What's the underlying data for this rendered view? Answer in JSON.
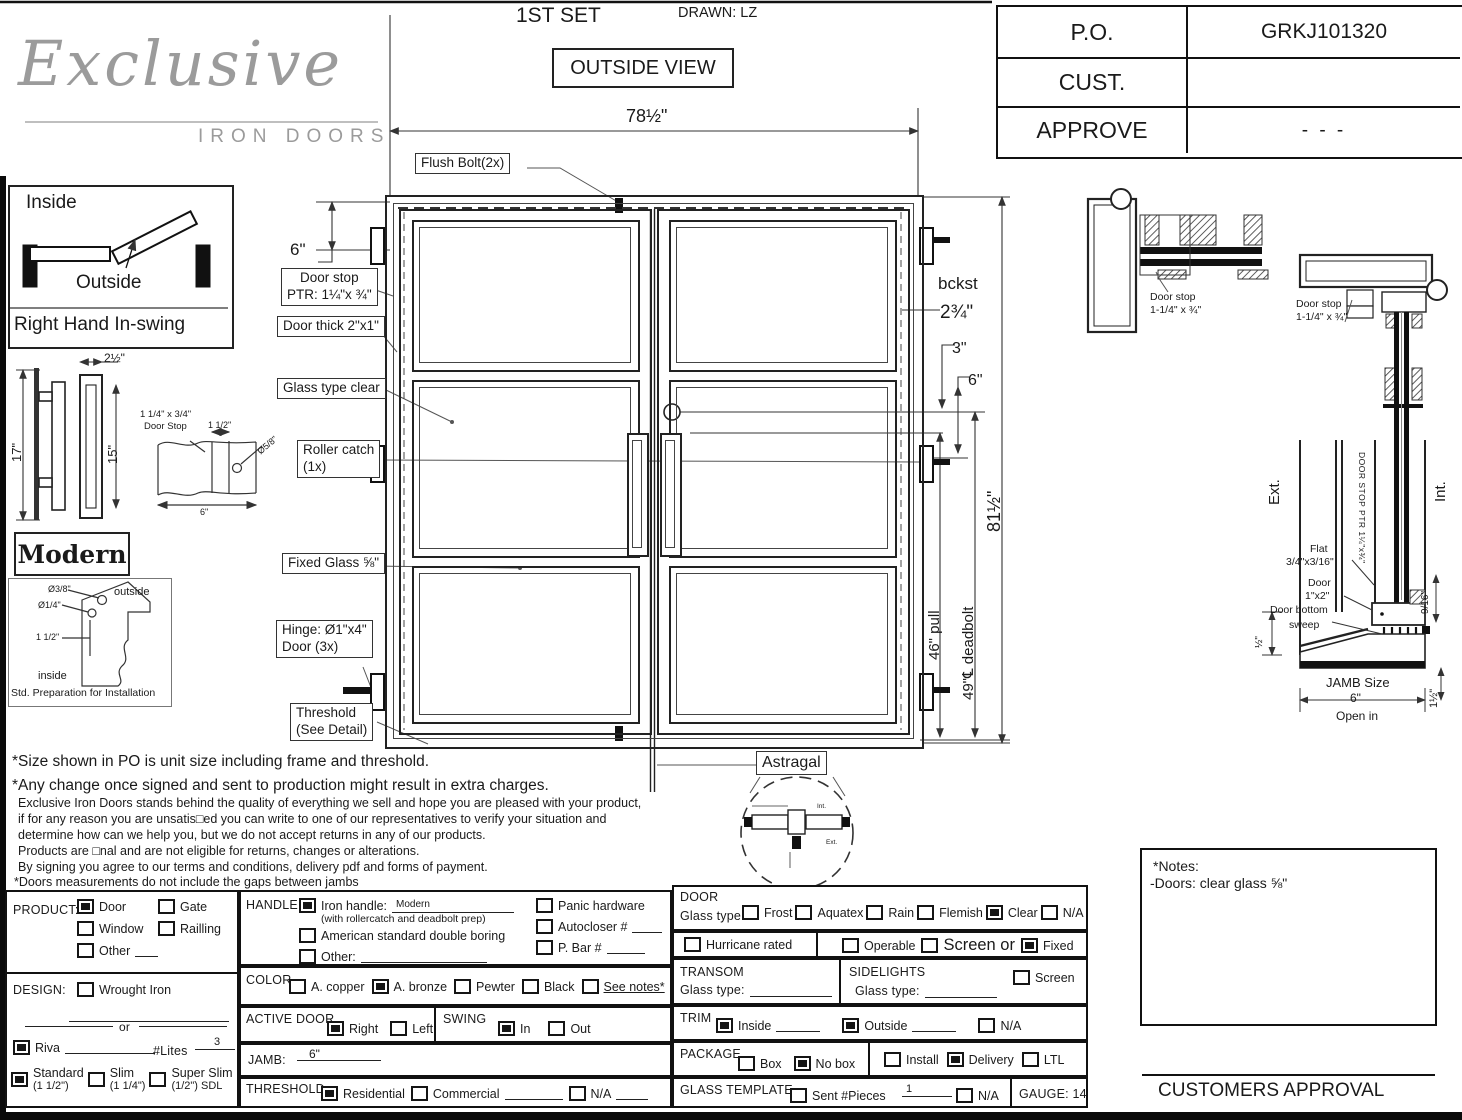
{
  "header": {
    "set_label": "1ST SET",
    "drawn_label": "DRAWN: LZ",
    "view_label": "OUTSIDE VIEW",
    "logo_script": "Exclusive",
    "logo_sub": "IRON DOORS",
    "po_table": {
      "rows": [
        {
          "label": "P.O.",
          "value": "GRKJ101320"
        },
        {
          "label": "CUST.",
          "value": ""
        },
        {
          "label": "APPROVE",
          "value": "- - -"
        }
      ]
    }
  },
  "left_panel": {
    "inside": "Inside",
    "outside": "Outside",
    "swing_caption": "Right Hand In-swing",
    "dim_17": "17\"",
    "dim_15": "15\"",
    "dim_2half": "2½\"",
    "style_name": "Modern",
    "stop_line1": "1 1/4\" x 3/4\"",
    "stop_line2": "Door Stop",
    "stop_dim1": "1 1/2\"",
    "stop_dim2": "Ø5/8\"",
    "stop_dim3": "6\"",
    "prep_dia1": "Ø3/8\"",
    "prep_dia2": "Ø1/4\"",
    "prep_dim": "1 1/2\"",
    "prep_outside": "outside",
    "prep_inside": "inside",
    "prep_caption": "Std. Preparation for Installation"
  },
  "drawing": {
    "dims": {
      "width": "78½\"",
      "height": "81½\"",
      "top_offset": "6\"",
      "bckst": "bckst",
      "bckst_val": "2¾\"",
      "d3": "3\"",
      "d6": "6\"",
      "pull": "46\" pull",
      "deadbolt": "49\"℄ deadbolt"
    },
    "callouts": {
      "flush_bolt": "Flush Bolt(2x)",
      "door_stop_l1": "Door stop",
      "door_stop_l2": "PTR: 1¼\"x ¾\"",
      "door_thick": "Door thick 2\"x1\"",
      "glass_type": "Glass type clear",
      "roller_l1": "Roller catch",
      "roller_l2": "(1x)",
      "fixed_glass": "Fixed Glass ⅝\"",
      "hinge_l1": "Hinge: Ø1\"x4\"",
      "hinge_l2": "Door (3x)",
      "threshold_l1": "Threshold",
      "threshold_l2": "(See Detail)",
      "astragal": "Astragal"
    },
    "astragal_detail": {
      "int": "Int.",
      "ext": "Ext."
    },
    "details": {
      "hinge_plan_l1": "Door stop",
      "hinge_plan_l2": "1-1/4\" x ¾\"",
      "head_l1": "Door stop",
      "head_l2": "1-1/4\" x ¾\"",
      "ext": "Ext.",
      "int": "Int.",
      "door_stop_ptr": "DOOR STOP PTR 1¼\"x¾\"",
      "flat_l1": "Flat",
      "flat_l2": "3/4\"x3/16\"",
      "door12_l1": "Door",
      "door12_l2": "1\"x2\"",
      "sweep_l1": "Door bottom",
      "sweep_l2": "sweep",
      "half": "½\"",
      "nine16": "9/16\"",
      "jamb_size": "JAMB Size",
      "jamb_val": "6\"",
      "one_half": "1½\"",
      "open_in": "Open in"
    }
  },
  "disclaimer": {
    "big1": "*Size shown in PO is unit size including frame and threshold.",
    "big2": "*Any change once signed and sent to production might result in extra charges.",
    "s1": "Exclusive Iron Doors stands behind the quality of everything we sell and hope you are pleased with your product,",
    "s2": "if for any reason you are unsatis□ed you can write to one of our representatives to verify your situation and",
    "s3": "determine how can we help you, but we do not accept returns in any of our products.",
    "s4": "Products are □nal and are not eligible for returns, changes or alterations.",
    "s5": "By signing you agree to our terms and conditions, delivery pdf and forms of payment.",
    "s6": "*Doors measurements do not include the gaps between jambs"
  },
  "form": {
    "product": {
      "label": "PRODUCT:",
      "items": [
        {
          "label": "Door",
          "checked": true
        },
        {
          "label": "Gate",
          "checked": false
        },
        {
          "label": "Window",
          "checked": false
        },
        {
          "label": "Railling",
          "checked": false
        },
        {
          "label": "Other",
          "checked": false,
          "blank": 66
        }
      ]
    },
    "design": {
      "label": "DESIGN:",
      "items_top": [
        {
          "label": "Wrought Iron",
          "checked": false
        }
      ],
      "or_label": "or",
      "riva": [
        {
          "label": "Riva",
          "checked": true,
          "blank": 90
        }
      ],
      "lites_label": "#Lites",
      "lites_value": "3",
      "styles": [
        {
          "label": "Standard",
          "sub": "(1 1/2\")",
          "checked": true
        },
        {
          "label": "Slim",
          "sub": "(1 1/4\")",
          "checked": false
        },
        {
          "label": "Super Slim",
          "sub": "(1/2\") SDL",
          "checked": false
        }
      ]
    },
    "handle": {
      "label": "HANDLE",
      "iron_label": "Iron handle:",
      "iron_value": "Modern",
      "iron_checked": true,
      "iron_note": "(with rollercatch and deadbolt prep)",
      "american_label": "American standard double boring",
      "american_checked": false,
      "other_label": "Other:",
      "other_checked": false,
      "right_items": [
        {
          "label": "Panic hardware",
          "checked": false
        },
        {
          "label": "Autocloser #",
          "checked": false,
          "blank": 30
        },
        {
          "label": "P. Bar #",
          "checked": false,
          "blank": 38
        }
      ]
    },
    "color": {
      "label": "COLOR",
      "items": [
        {
          "label": "A. copper",
          "checked": false
        },
        {
          "label": "A. bronze",
          "checked": true
        },
        {
          "label": "Pewter",
          "checked": false
        },
        {
          "label": "Black",
          "checked": false
        },
        {
          "label": "See notes*",
          "checked": false,
          "underline": true
        }
      ]
    },
    "active_door": {
      "label": "ACTIVE DOOR",
      "items": [
        {
          "label": "Right",
          "checked": true
        },
        {
          "label": "Left",
          "checked": false
        }
      ]
    },
    "swing": {
      "label": "SWING",
      "items": [
        {
          "label": "In",
          "checked": true
        },
        {
          "label": "Out",
          "checked": false
        }
      ]
    },
    "jamb": {
      "label": "JAMB:",
      "value": "6\""
    },
    "threshold": {
      "label": "THRESHOLD",
      "items": [
        {
          "label": "Residential",
          "checked": true
        },
        {
          "label": "Commercial",
          "checked": false,
          "blank": 58
        },
        {
          "label": "N/A",
          "checked": false,
          "blank": 32
        }
      ]
    },
    "door_section": {
      "label": "DOOR",
      "glass_label": "Glass type",
      "items": [
        {
          "label": "Frost",
          "checked": false
        },
        {
          "label": "Aquatex",
          "checked": false
        },
        {
          "label": "Rain",
          "checked": false
        },
        {
          "label": "Flemish",
          "checked": false
        },
        {
          "label": "Clear",
          "checked": true
        },
        {
          "label": "N/A",
          "checked": false
        }
      ]
    },
    "hurricane": {
      "items": [
        {
          "label": "Hurricane rated",
          "checked": false
        }
      ]
    },
    "operable": {
      "items": [
        {
          "label": "Operable",
          "checked": false
        },
        {
          "label": "Screen or",
          "checked": false,
          "big": true
        },
        {
          "label": "Fixed",
          "checked": true
        }
      ]
    },
    "transom": {
      "label": "TRANSOM",
      "glass_label": "Glass type:"
    },
    "sidelights": {
      "label": "SIDELIGHTS",
      "glass_label": "Glass type:",
      "screen_items": [
        {
          "label": "Screen",
          "checked": false
        }
      ]
    },
    "trim": {
      "label": "TRIM",
      "items": [
        {
          "label": "Inside",
          "checked": true,
          "blank": 44
        },
        {
          "label": "Outside",
          "checked": true,
          "blank": 44
        },
        {
          "label": "N/A",
          "checked": false
        }
      ]
    },
    "package": {
      "label": "PACKAGE",
      "items1": [
        {
          "label": "Box",
          "checked": false
        },
        {
          "label": "No box",
          "checked": true
        }
      ],
      "items2": [
        {
          "label": "Install",
          "checked": false
        },
        {
          "label": "Delivery",
          "checked": true
        },
        {
          "label": "LTL",
          "checked": false
        }
      ]
    },
    "glass_template": {
      "label": "GLASS TEMPLATE",
      "sent_items": [
        {
          "label": "Sent #Pieces",
          "checked": false
        }
      ],
      "pieces_value": "1",
      "na_items": [
        {
          "label": "N/A",
          "checked": false
        }
      ]
    },
    "gauge_label": "GAUGE: 14"
  },
  "notes_box": {
    "title": "*Notes:",
    "line1": "-Doors: clear glass ⅝\""
  },
  "approval_label": "CUSTOMERS APPROVAL"
}
